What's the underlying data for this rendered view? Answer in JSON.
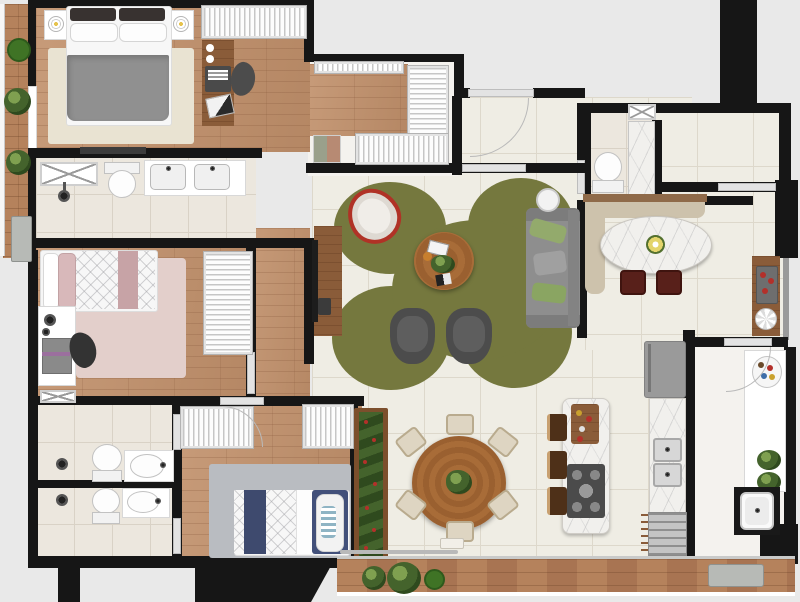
{
  "title": "apartment-floor-plan-top-view",
  "palette": {
    "bg": "#e9e9e9",
    "wall": "#161616",
    "wood_a": "#c79b79",
    "wood_b": "#b58764",
    "wood_dark": "#8a5c39",
    "deck_a": "#b5825c",
    "deck_b": "#a87452",
    "tile": "#efede4",
    "grout": "#ddd8cb",
    "btile": "#ece7de",
    "bgrout": "#d9d2c6",
    "plain": "#f4f2ee",
    "marble": "#f1f0ed",
    "rug_living": "#75783e",
    "rug_master": "#e9e3d2",
    "rug_pink": "#e3cfcb",
    "rug_blue": "#b9bcc1",
    "sofa": "#8e8e8e",
    "sofa_dark": "#7c7c7c",
    "pillow_green": "#93aa6c",
    "armchair": "#4c4c4c",
    "armchair_seat": "#5e5e5e",
    "table_wood": "#a06434",
    "banquette": "#cdc2ac",
    "banquette_wood": "#8f6a49",
    "dining_chair": "#58201a",
    "cream_chair": "#ded5c2",
    "cream_chair_line": "#b9ab8e",
    "duvet": "#909090",
    "navy": "#3e4a6e",
    "pink_band": "#c7a3a6",
    "pink_pillow": "#d8b8ba",
    "stool": "#4e3018",
    "fridge": "#9a9a9a",
    "cooktop": "#4b4b4b",
    "steel": "#c4c4c4",
    "plant_dark": "#2f4a1e",
    "plant_mid": "#44632c",
    "plant_light": "#7fa050",
    "plant_solid": "#3f7325",
    "egg_red": "#b03226",
    "planter_gray": "#b7bab6",
    "flower_red": "#b3302a",
    "glass": "#c9cac9",
    "door": "#e3e3e3"
  },
  "rooms": [
    {
      "name": "master-bedroom",
      "floor": "wood",
      "furniture": [
        "double-bed",
        "headboard-pillows",
        "nightstand-left",
        "nightstand-right",
        "table-lamps",
        "area-rug",
        "wardrobe",
        "desk",
        "laptop",
        "desk-chair",
        "tv-panel"
      ]
    },
    {
      "name": "walk-in-closet",
      "floor": "light",
      "furniture": [
        "hanging-rack-top",
        "hanging-rack-right",
        "hanging-rack-bottom",
        "folded-clothes"
      ]
    },
    {
      "name": "master-bathroom",
      "floor": "bath-tile",
      "furniture": [
        "shower-box",
        "shower-mixer",
        "toilet",
        "double-sink-vanity"
      ]
    },
    {
      "name": "balcony-left",
      "floor": "deck-wood",
      "furniture": [
        "plant-1",
        "plant-2",
        "plant-3",
        "planter-tray"
      ]
    },
    {
      "name": "bedroom-pink",
      "floor": "wood",
      "furniture": [
        "single-bed",
        "pink-rug",
        "desk",
        "headphones",
        "laptop",
        "desk-chair",
        "wardrobe"
      ]
    },
    {
      "name": "bedroom-blue",
      "floor": "wood",
      "furniture": [
        "wardrobe-left",
        "wardrobe-right",
        "gray-rug",
        "single-bed-navy",
        "striped-pillow",
        "flower-planter"
      ]
    },
    {
      "name": "bathroom-2",
      "floor": "bath-tile",
      "furniture": [
        "shower-mixer",
        "toilet",
        "oval-sink-vanity"
      ]
    },
    {
      "name": "bathroom-3",
      "floor": "bath-tile",
      "furniture": [
        "shower-mixer",
        "toilet",
        "oval-sink-vanity"
      ]
    },
    {
      "name": "hallway",
      "floor": "wood",
      "furniture": []
    },
    {
      "name": "entry",
      "floor": "tile",
      "furniture": [
        "entry-door"
      ]
    },
    {
      "name": "powder-room",
      "floor": "bath-tile",
      "furniture": [
        "toilet",
        "marble-shower",
        "duct-shaft"
      ]
    },
    {
      "name": "living-room",
      "floor": "tile",
      "furniture": [
        "organic-green-rug",
        "round-coffee-table",
        "hanging-egg-chair",
        "armchair-1",
        "armchair-2",
        "sofa",
        "green-cushions",
        "round-side-table",
        "tv-console",
        "tv",
        "remote"
      ]
    },
    {
      "name": "dining-room",
      "floor": "tile",
      "furniture": [
        "l-shaped-banquette",
        "oval-marble-table",
        "flower-centerpiece",
        "dining-chair-1",
        "dining-chair-2",
        "bar-console",
        "drink-tray"
      ]
    },
    {
      "name": "kitchen",
      "floor": "tile",
      "furniture": [
        "island-with-cooktop",
        "cutting-board",
        "bar-stools-x3",
        "counter",
        "double-sink",
        "oven",
        "fridge",
        "round-dining-table",
        "cream-chairs-x6",
        "plant-centerpiece"
      ]
    },
    {
      "name": "service-area",
      "floor": "light",
      "furniture": [
        "counter",
        "plate",
        "plants",
        "laundry-tub"
      ]
    },
    {
      "name": "terrace-bottom",
      "floor": "deck-wood",
      "furniture": [
        "plant-group-x3",
        "planter-tray",
        "glass-rail"
      ]
    }
  ],
  "exterior": {
    "structures": [
      "column-top-right",
      "column-left",
      "column-bottom-left",
      "building-mass-bottom"
    ]
  }
}
